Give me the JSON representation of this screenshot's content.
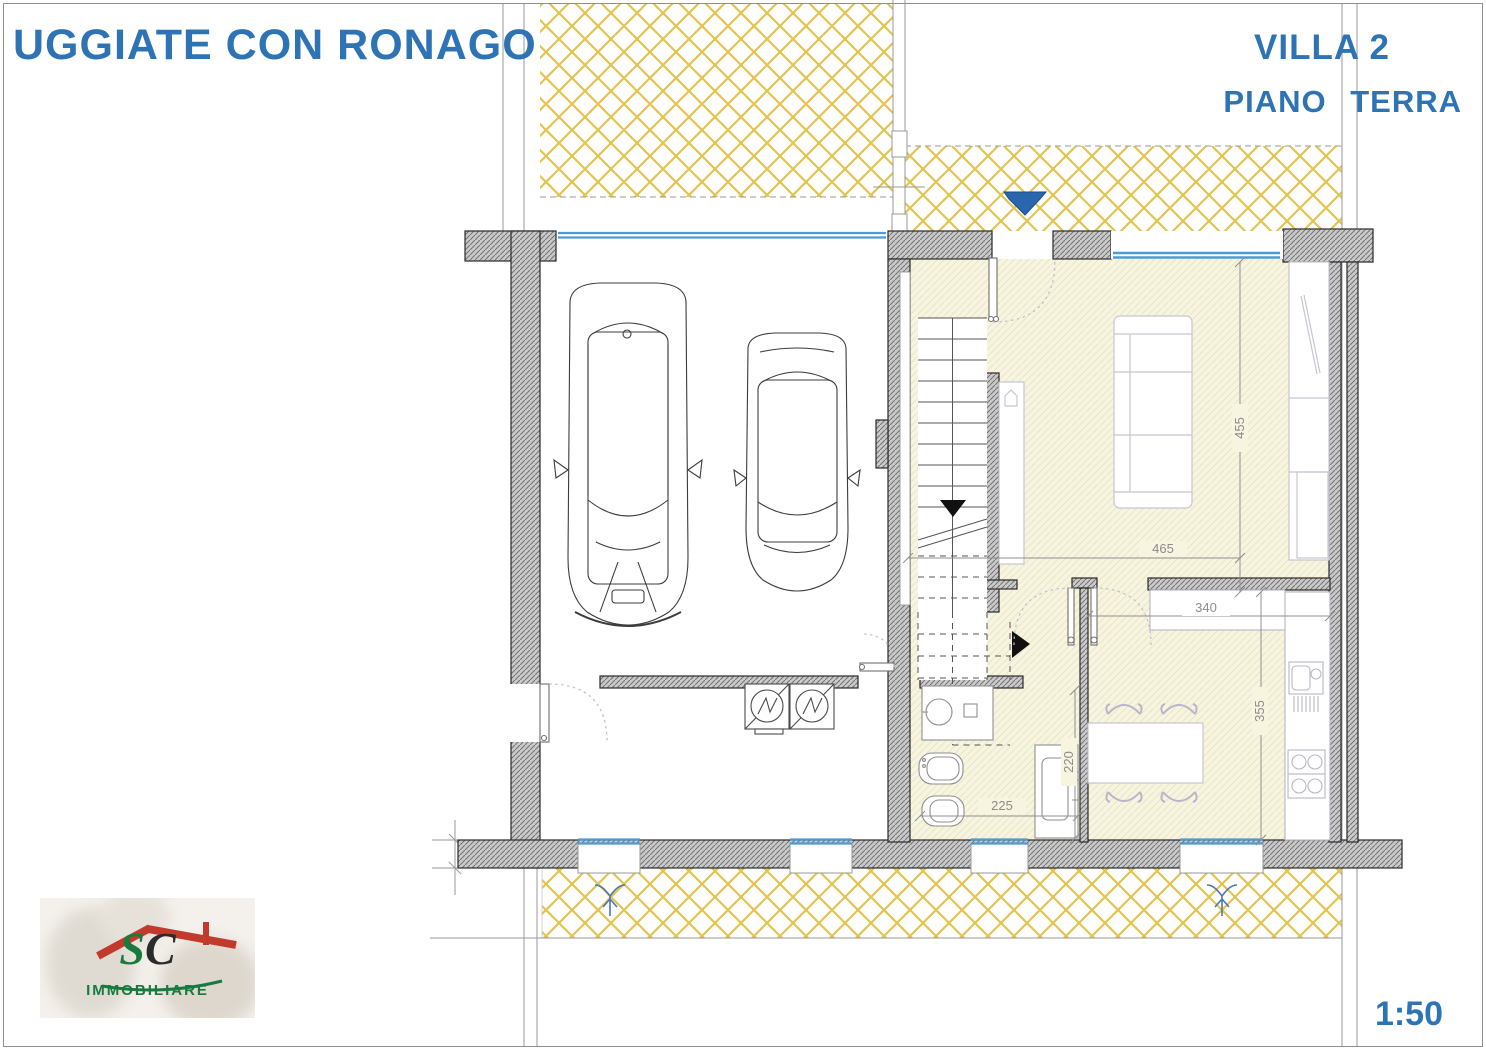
{
  "header": {
    "location_title": "UGGIATE CON RONAGO",
    "villa_title": "VILLA 2",
    "floor_title": "PIANO TERRA"
  },
  "footer": {
    "scale": "1:50"
  },
  "logo": {
    "letter_s": "S",
    "letter_c": "C",
    "company": "IMMOBILIARE"
  },
  "dimensions": {
    "living_room_depth": "455",
    "living_room_width": "465",
    "kitchen_width": "340",
    "kitchen_depth": "355",
    "utility_depth": "220",
    "bathroom_width": "225"
  },
  "colors": {
    "accent_blue": "#2e74b5",
    "hatch_yellow": "#e3c44f",
    "floor_tint": "#f7f4df",
    "wall_gray": "#cacaca",
    "window_blue": "#4d9bd5",
    "dimension_gray": "#8c8c8c",
    "logo_green": "#177a3e",
    "logo_red": "#c23a2b"
  }
}
